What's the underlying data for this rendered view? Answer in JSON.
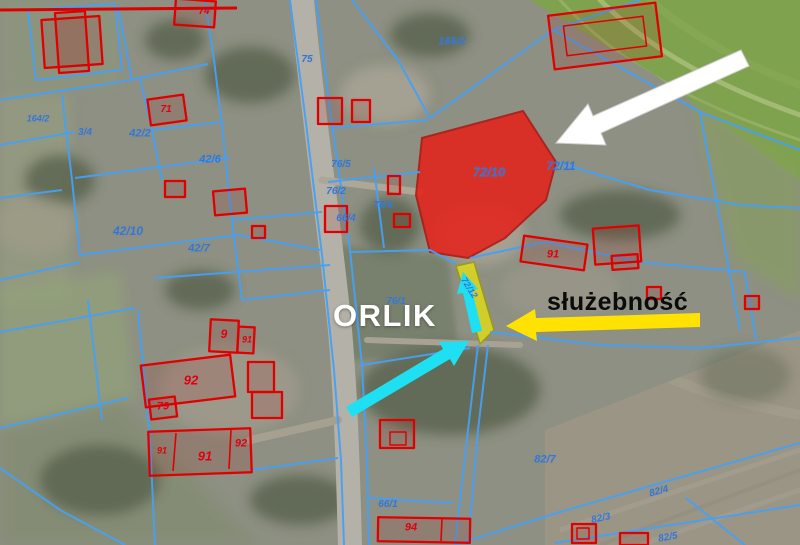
{
  "annotations": {
    "orlik": "ORLIK",
    "sluzebnosc": "służebność"
  },
  "colors": {
    "parcel_line": "#46a1f5",
    "building_line": "#e00000",
    "parcel_text": "#3576d2",
    "building_text": "#e00010",
    "red_parcel_fill": "#e3231b",
    "easement_strip_fill": "#e3de17",
    "white_arrow": "#ffffff",
    "yellow_arrow": "#ffe202",
    "cyan_arrow": "#1ee0f2",
    "red_boundary": "#dd0000"
  },
  "highlighted_parcel": {
    "label": "72/10"
  },
  "arrows": [
    {
      "name": "white-arrow",
      "color": "#ffffff"
    },
    {
      "name": "yellow-arrow",
      "color": "#ffe202"
    },
    {
      "name": "cyan-arrow-up",
      "color": "#1ee0f2"
    },
    {
      "name": "cyan-arrow-diagonal",
      "color": "#1ee0f2"
    }
  ],
  "parcel_labels": [
    {
      "text": "164/2",
      "x": 38,
      "y": 119,
      "size": 9
    },
    {
      "text": "165/2",
      "x": 452,
      "y": 42,
      "size": 11
    },
    {
      "text": "75",
      "x": 307,
      "y": 60,
      "size": 10
    },
    {
      "text": "76/5",
      "x": 341,
      "y": 165,
      "size": 10
    },
    {
      "text": "76/2",
      "x": 336,
      "y": 192,
      "size": 10
    },
    {
      "text": "66/4",
      "x": 346,
      "y": 219,
      "size": 10
    },
    {
      "text": "76/4",
      "x": 383,
      "y": 206,
      "size": 10
    },
    {
      "text": "42/2",
      "x": 140,
      "y": 134,
      "size": 11
    },
    {
      "text": "3/4",
      "x": 85,
      "y": 133,
      "size": 10
    },
    {
      "text": "42/6",
      "x": 210,
      "y": 160,
      "size": 11
    },
    {
      "text": "42/10",
      "x": 128,
      "y": 231,
      "size": 12
    },
    {
      "text": "42/7",
      "x": 199,
      "y": 249,
      "size": 11
    },
    {
      "text": "72/10",
      "x": 489,
      "y": 172,
      "size": 13
    },
    {
      "text": "72/11",
      "x": 561,
      "y": 166,
      "size": 12
    },
    {
      "text": "76/1",
      "x": 396,
      "y": 302,
      "size": 10
    },
    {
      "text": "72/12",
      "x": 469,
      "y": 288,
      "size": 9,
      "rot": 58
    },
    {
      "text": "82/7",
      "x": 545,
      "y": 460,
      "size": 11
    },
    {
      "text": "66/1",
      "x": 388,
      "y": 505,
      "size": 10
    },
    {
      "text": "82/4",
      "x": 659,
      "y": 492,
      "size": 10,
      "rot": -15
    },
    {
      "text": "82/3",
      "x": 601,
      "y": 519,
      "size": 10,
      "rot": -12
    },
    {
      "text": "82/5",
      "x": 668,
      "y": 538,
      "size": 10,
      "rot": -10
    }
  ],
  "building_labels": [
    {
      "text": "74",
      "x": 204,
      "y": 12,
      "size": 10
    },
    {
      "text": "71",
      "x": 166,
      "y": 110,
      "size": 10
    },
    {
      "text": "9",
      "x": 224,
      "y": 334,
      "size": 12
    },
    {
      "text": "91",
      "x": 247,
      "y": 340,
      "size": 9
    },
    {
      "text": "92",
      "x": 191,
      "y": 380,
      "size": 13
    },
    {
      "text": "79",
      "x": 163,
      "y": 407,
      "size": 11
    },
    {
      "text": "91",
      "x": 162,
      "y": 451,
      "size": 9
    },
    {
      "text": "91",
      "x": 205,
      "y": 456,
      "size": 13
    },
    {
      "text": "92",
      "x": 241,
      "y": 444,
      "size": 11
    },
    {
      "text": "91",
      "x": 553,
      "y": 255,
      "size": 11
    },
    {
      "text": "94",
      "x": 411,
      "y": 528,
      "size": 11
    }
  ]
}
